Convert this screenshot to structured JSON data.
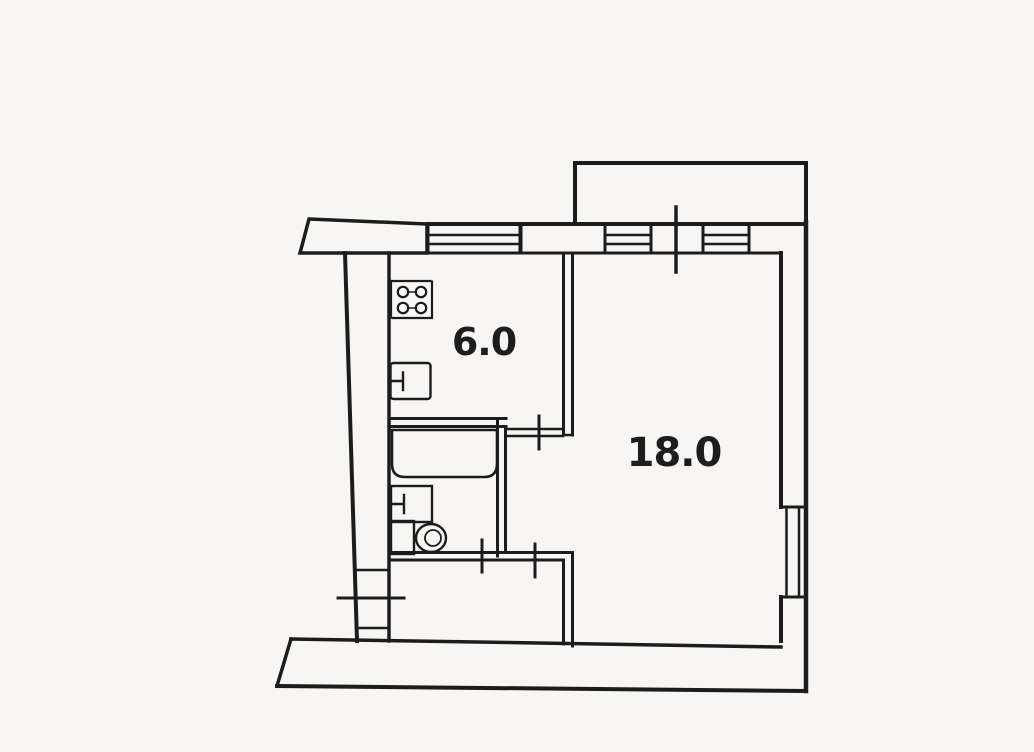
{
  "plan": {
    "type": "apartment-floor-plan",
    "rooms": {
      "kitchen": {
        "name": "kitchen",
        "area": "6.0"
      },
      "living_room": {
        "name": "living-room",
        "area": "18.0"
      },
      "bathroom": {
        "name": "bathroom",
        "area": ""
      },
      "hallway": {
        "name": "hallway",
        "area": ""
      },
      "balcony": {
        "name": "balcony",
        "area": ""
      }
    },
    "fixtures": [
      "stove-icon",
      "kitchen-sink-icon",
      "bathtub-icon",
      "washbasin-icon",
      "toilet-icon"
    ],
    "openings": [
      "balcony-door-tick",
      "kitchen-door-tick",
      "bathroom-door-tick",
      "corridor-door-tick",
      "entrance-door-tick"
    ],
    "colors": {
      "paper": "#f7f6f4",
      "ink": "#1c1c1c"
    }
  }
}
